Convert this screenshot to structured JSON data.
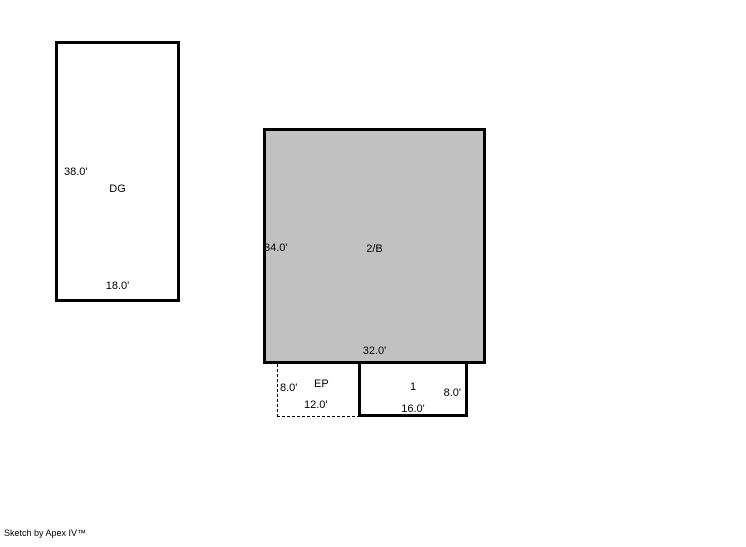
{
  "sketch": {
    "areas": {
      "garage": {
        "label": "DG",
        "dim_left": "38.0'",
        "dim_bottom": "18.0'"
      },
      "main": {
        "label": "2/B",
        "dim_left": "34.0'",
        "dim_bottom": "32.0'"
      },
      "enclosed_porch": {
        "label": "EP",
        "dim_left": "8.0'",
        "dim_bottom": "12.0'"
      },
      "porch": {
        "label": "1",
        "dim_right": "8.0'",
        "dim_bottom": "16.0'"
      }
    },
    "colors": {
      "main_fill": "#c1c1c1",
      "outline": "#000000",
      "background": "#ffffff"
    },
    "footer": {
      "credit": "Sketch by Apex IV™"
    }
  }
}
